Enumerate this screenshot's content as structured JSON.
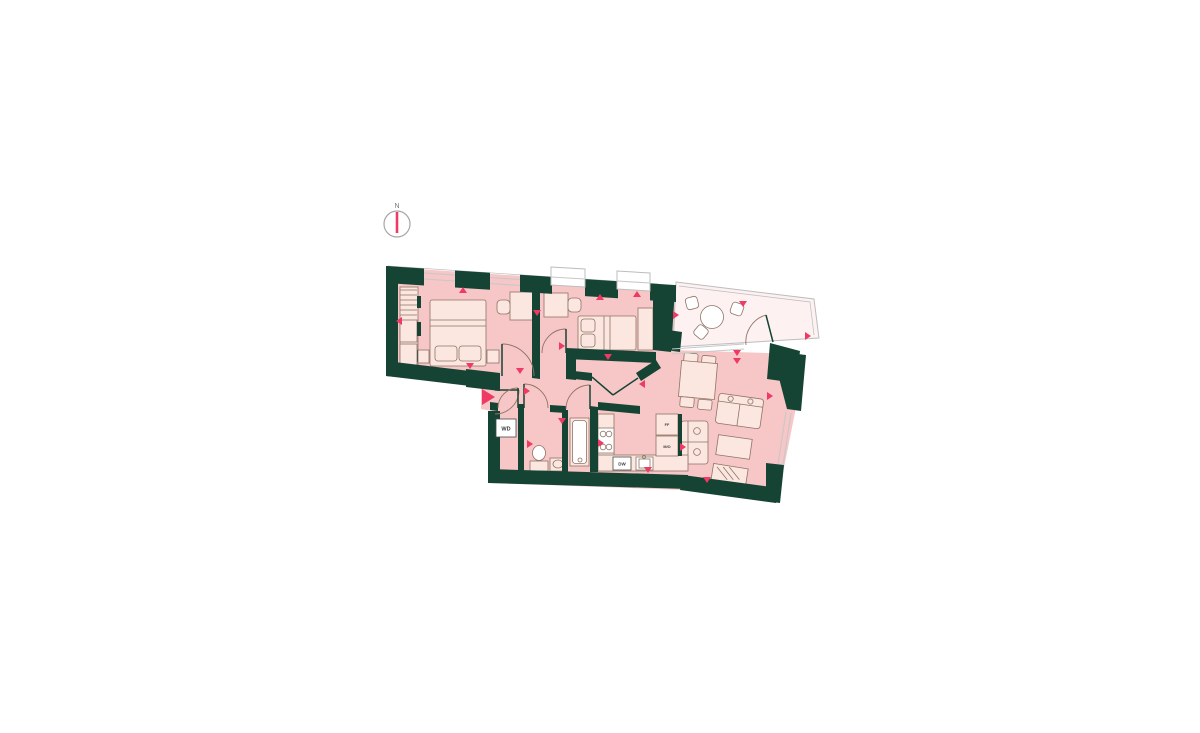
{
  "colors": {
    "wall": "#164434",
    "floor": "#f7c6c6",
    "balcony_floor": "#fdf1f1",
    "furniture_fill": "#fbe7df",
    "furniture_stroke": "#8f7466",
    "outline": "#bdbdbd",
    "window": "#c8c8c8",
    "accent": "#ee3a64",
    "compass_ring": "#a5a5a5"
  },
  "compass": {
    "north_label": "N"
  },
  "labels": {
    "washer_dryer": "WD",
    "dishwasher": "DW",
    "fridge_freezer": "FF",
    "microwave_oven": "M/O"
  }
}
